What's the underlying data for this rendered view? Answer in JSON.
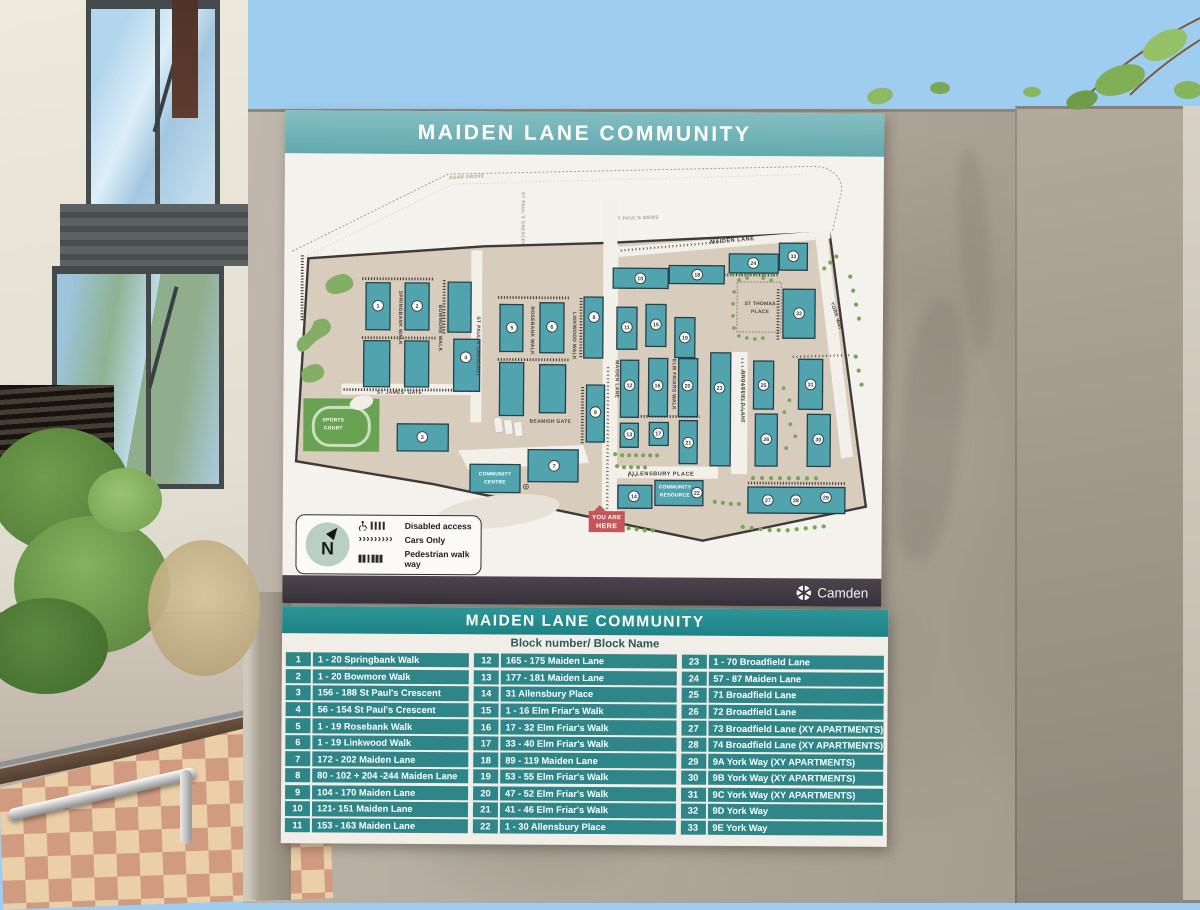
{
  "colors": {
    "header_teal": "#6cacb1",
    "table_teal": "#2e8689",
    "table_header_teal": "#218689",
    "estate_beige": "#d8ccbc",
    "building_teal": "#51a3ad",
    "marker_red": "#c4565a",
    "sign_white": "#f4f2ec",
    "footer_dark": "#3a343c"
  },
  "sign": {
    "header": {
      "title": "MAIDEN LANE COMMUNITY"
    },
    "legend": {
      "compass": "N",
      "items": [
        "Disabled access",
        "Cars Only",
        "Pedestrian walk way"
      ]
    },
    "footer": {
      "brand": "Camden"
    },
    "map": {
      "roads": {
        "agar_grove": "AGAR GROVE",
        "st_pauls_mews": "ST PAUL'S MEWS",
        "st_pauls_crescent_top": "ST PAUL'S CRESCENT",
        "st_pauls_crescent": "ST PAUL'S CRESCENT",
        "springbank_walk": "SPRINGBANK WALK",
        "bowmore_walk": "BOWMORE WALK",
        "rosebank_walk": "ROSEBANK WALK",
        "linkwood_walk": "LINKWOOD WALK",
        "maiden_lane_vertical": "MAIDEN LANE",
        "maiden_lane_top": "MAIDEN LANE",
        "elm_friars_walk": "ELM FRIARS WALK",
        "broadfield_lane": "BROADFIELD LANE",
        "york_way": "YORK WAY",
        "st_james_gate": "ST JAMES' GATE",
        "beamish_gate": "BEAMISH GATE",
        "allensbury_place": "ALLENSBURY PLACE"
      },
      "places": {
        "sports_court_1": "SPORTS",
        "sports_court_2": "COURT",
        "community_centre_1": "COMMUNITY",
        "community_centre_2": "CENTRE",
        "community_resource_1": "COMMUNITY",
        "community_resource_2": "RESOURCE",
        "st_thomas_1": "ST THOMAS",
        "st_thomas_2": "PLACE"
      },
      "marker": {
        "line1": "YOU ARE",
        "line2": "HERE"
      },
      "routes": {
        "maiden_vertical": "››››››››››››››››››››››››››››››››››››››››",
        "maiden_top": "››››››››››››››››››››››››››››",
        "st_thomas_row": "››››››››››››››››",
        "broadfield": "››››››››››››››››",
        "allensbury": "›››"
      },
      "block_numbers": [
        "1",
        "2",
        "3",
        "4",
        "5",
        "6",
        "7",
        "8",
        "9",
        "10",
        "11",
        "12",
        "13",
        "14",
        "15",
        "16",
        "17",
        "18",
        "19",
        "20",
        "21",
        "22",
        "23",
        "24",
        "25",
        "26",
        "27",
        "28",
        "29",
        "30",
        "31",
        "32",
        "33"
      ]
    },
    "table": {
      "title": "MAIDEN LANE COMMUNITY",
      "header": "Block number/ Block Name",
      "columns": [
        [
          {
            "num": "1",
            "name": "1 - 20  Springbank Walk"
          },
          {
            "num": "2",
            "name": "1 - 20 Bowmore Walk"
          },
          {
            "num": "3",
            "name": "156 - 188 St Paul's Crescent"
          },
          {
            "num": "4",
            "name": "56 - 154 St Paul's Crescent"
          },
          {
            "num": "5",
            "name": "1 - 19 Rosebank Walk"
          },
          {
            "num": "6",
            "name": "1 - 19 Linkwood Walk"
          },
          {
            "num": "7",
            "name": "172 - 202  Maiden Lane"
          },
          {
            "num": "8",
            "name": "80 - 102 + 204 -244 Maiden Lane"
          },
          {
            "num": "9",
            "name": "104 - 170 Maiden Lane"
          },
          {
            "num": "10",
            "name": "121- 151 Maiden Lane"
          },
          {
            "num": "11",
            "name": "153 - 163 Maiden Lane"
          }
        ],
        [
          {
            "num": "12",
            "name": "165 - 175 Maiden Lane"
          },
          {
            "num": "13",
            "name": "177 - 181 Maiden Lane"
          },
          {
            "num": "14",
            "name": "31 Allensbury Place"
          },
          {
            "num": "15",
            "name": "1 - 16 Elm Friar's Walk"
          },
          {
            "num": "16",
            "name": "17 - 32 Elm Friar's Walk"
          },
          {
            "num": "17",
            "name": "33 - 40 Elm Friar's Walk"
          },
          {
            "num": "18",
            "name": "89 - 119 Maiden Lane"
          },
          {
            "num": "19",
            "name": "53 - 55 Elm Friar's Walk"
          },
          {
            "num": "20",
            "name": "47 - 52 Elm Friar's Walk"
          },
          {
            "num": "21",
            "name": "41 - 46 Elm Friar's Walk"
          },
          {
            "num": "22",
            "name": "1 - 30 Allensbury Place"
          }
        ],
        [
          {
            "num": "23",
            "name": "1 - 70 Broadfield Lane"
          },
          {
            "num": "24",
            "name": "57 - 87 Maiden Lane"
          },
          {
            "num": "25",
            "name": "71 Broadfield Lane"
          },
          {
            "num": "26",
            "name": "72 Broadfield Lane"
          },
          {
            "num": "27",
            "name": "73 Broadfield Lane (XY APARTMENTS)"
          },
          {
            "num": "28",
            "name": "74 Broadfield Lane (XY APARTMENTS)"
          },
          {
            "num": "29",
            "name": "9A York Way (XY APARTMENTS)"
          },
          {
            "num": "30",
            "name": "9B York Way (XY APARTMENTS)"
          },
          {
            "num": "31",
            "name": "9C York Way (XY APARTMENTS)"
          },
          {
            "num": "32",
            "name": "9D York Way"
          },
          {
            "num": "33",
            "name": "9E York Way"
          }
        ]
      ]
    }
  }
}
